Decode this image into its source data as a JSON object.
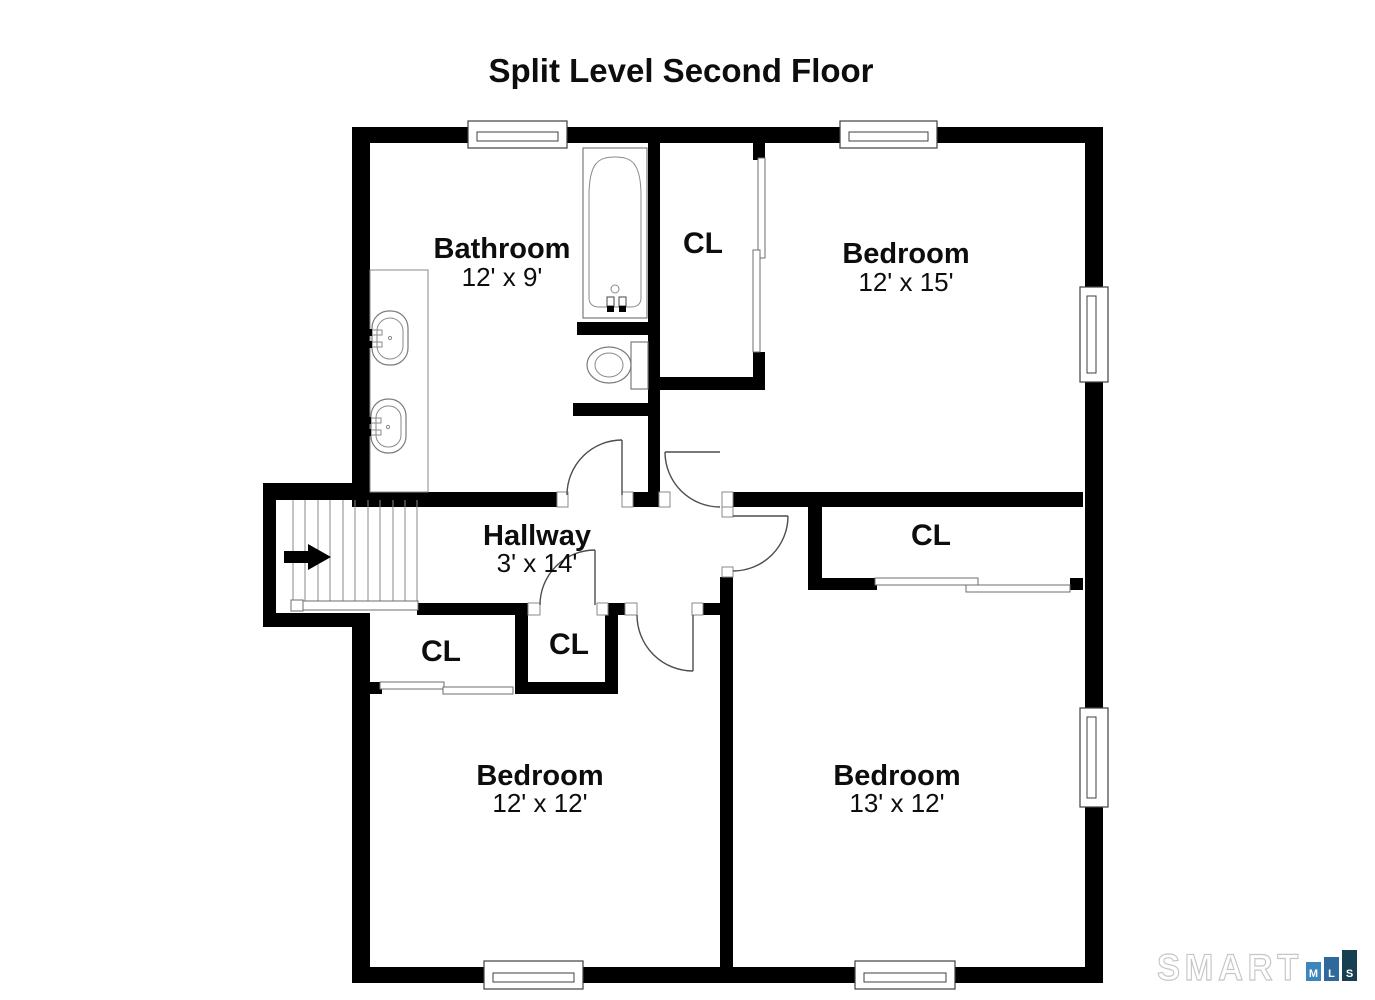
{
  "title": "Split Level Second Floor",
  "floor_plan": {
    "rooms": [
      {
        "id": "bathroom",
        "name": "Bathroom",
        "dims": "12' x 9'"
      },
      {
        "id": "bedroom-top",
        "name": "Bedroom",
        "dims": "12' x 15'"
      },
      {
        "id": "hallway",
        "name": "Hallway",
        "dims": "3' x 14'"
      },
      {
        "id": "bedroom-left",
        "name": "Bedroom",
        "dims": "12' x 12'"
      },
      {
        "id": "bedroom-right",
        "name": "Bedroom",
        "dims": "13' x 12'"
      }
    ],
    "closets": [
      {
        "id": "closet-top",
        "label": "CL"
      },
      {
        "id": "closet-right",
        "label": "CL"
      },
      {
        "id": "closet-hall-left",
        "label": "CL"
      },
      {
        "id": "closet-hall-mid",
        "label": "CL"
      }
    ]
  },
  "logo": {
    "brand": "SMART",
    "blocks": [
      {
        "letter": "M",
        "color": "#3c85bd"
      },
      {
        "letter": "L",
        "color": "#2f699b"
      },
      {
        "letter": "S",
        "color": "#16404f"
      }
    ]
  }
}
